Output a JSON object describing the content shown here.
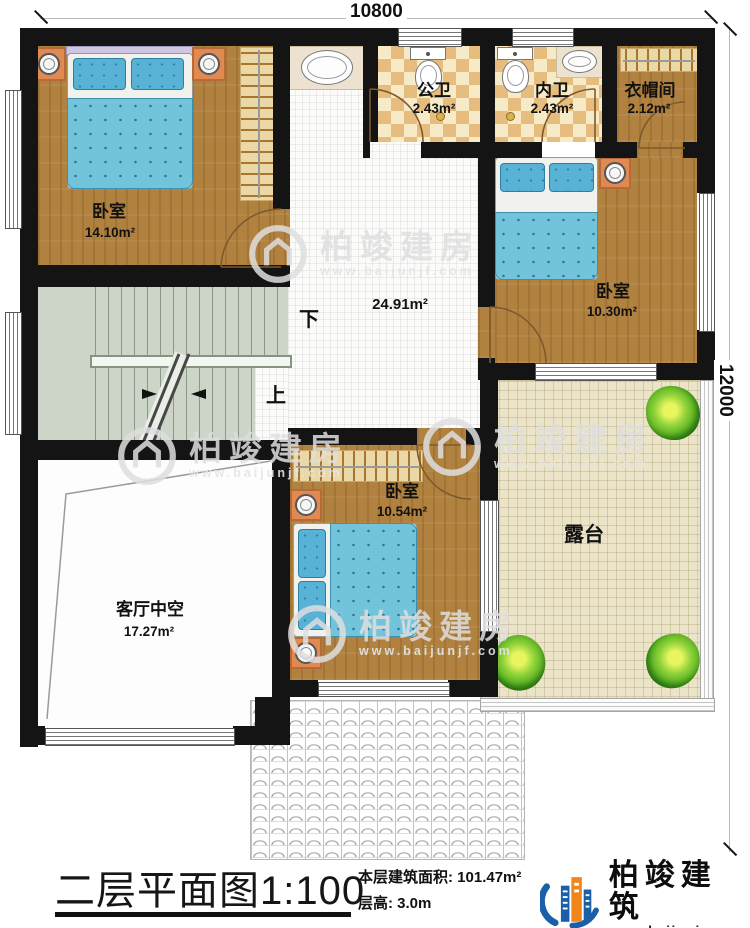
{
  "plan": {
    "rooms": {
      "bedroom_topleft": {
        "label": "卧室",
        "area": "14.10m²"
      },
      "public_bath": {
        "label": "公卫",
        "area": "2.43m²"
      },
      "inner_bath": {
        "label": "内卫",
        "area": "2.43m²"
      },
      "cloakroom": {
        "label": "衣帽间",
        "area": "2.12m²"
      },
      "bedroom_right": {
        "label": "卧室",
        "area": "10.30m²"
      },
      "hall": {
        "area": "24.91m²"
      },
      "bedroom_middle": {
        "label": "卧室",
        "area": "10.54m²"
      },
      "living_void": {
        "label": "客厅中空",
        "area": "17.27m²"
      },
      "terrace": {
        "label": "露台"
      }
    },
    "stairs": {
      "down_label": "下",
      "up_label": "上"
    },
    "dimensions": {
      "top": "10800",
      "right": "12000"
    }
  },
  "titleblock": {
    "title": "二层平面图",
    "scale": "1:100",
    "floor_area_label": "本层建筑面积:",
    "floor_area_value": "101.47m²",
    "floor_height_label": "层高:",
    "floor_height_value": "3.0m"
  },
  "brand": {
    "name": "柏竣建筑",
    "website": "www.baijunjz.com"
  },
  "watermark": {
    "text": "柏竣建房",
    "website": "www.baijunjf.com"
  },
  "colors": {
    "wall": "#141414",
    "wood": "#b1823f",
    "bed_blue": "#72c4db",
    "stairs_green": "#cdd5c9",
    "terrace_beige": "#ece4c8",
    "bath_tile": "#e6bd7e",
    "nightstand_orange": "#e08a52",
    "logo_blue": "#1a5fa8",
    "logo_orange": "#f08519"
  }
}
